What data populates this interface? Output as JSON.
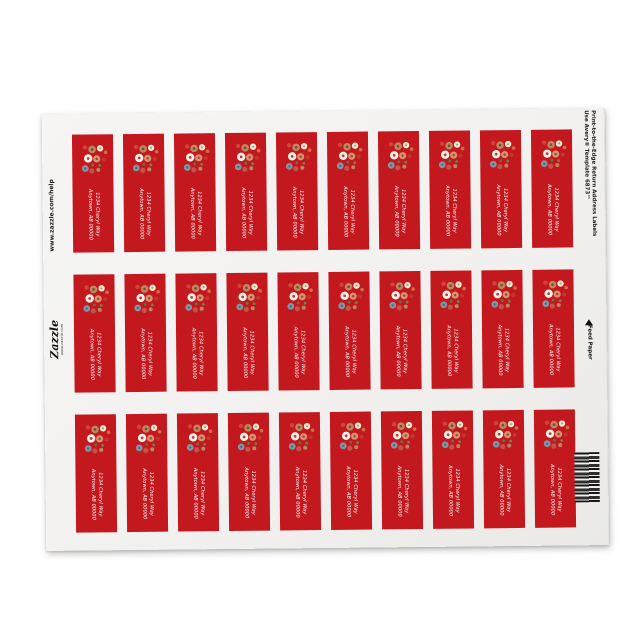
{
  "page": {
    "background": "#ffffff"
  },
  "sheet": {
    "background": "#f2f1ef",
    "left_margin": {
      "help_url": "www.zazzle.com/help",
      "logo_text": "Zazzle",
      "logo_subtext": "www.zazzle.com"
    },
    "right_margin": {
      "caption_line1": "Print-to-the-Edge Return Address Labels",
      "caption_line2": "Use Avery® Template 6873™",
      "feed_label": "Feed Paper",
      "feed_arrow_icon": "triangle-up"
    },
    "barcode": "barcode"
  },
  "label": {
    "background_color": "#c2181e",
    "graphic": "floral-bouquet",
    "address_line1": "1234 Cheryl Way",
    "address_line2": "Anytown, AB 00000"
  },
  "grid": {
    "rows": 3,
    "columns": 10,
    "total_labels": 30
  }
}
